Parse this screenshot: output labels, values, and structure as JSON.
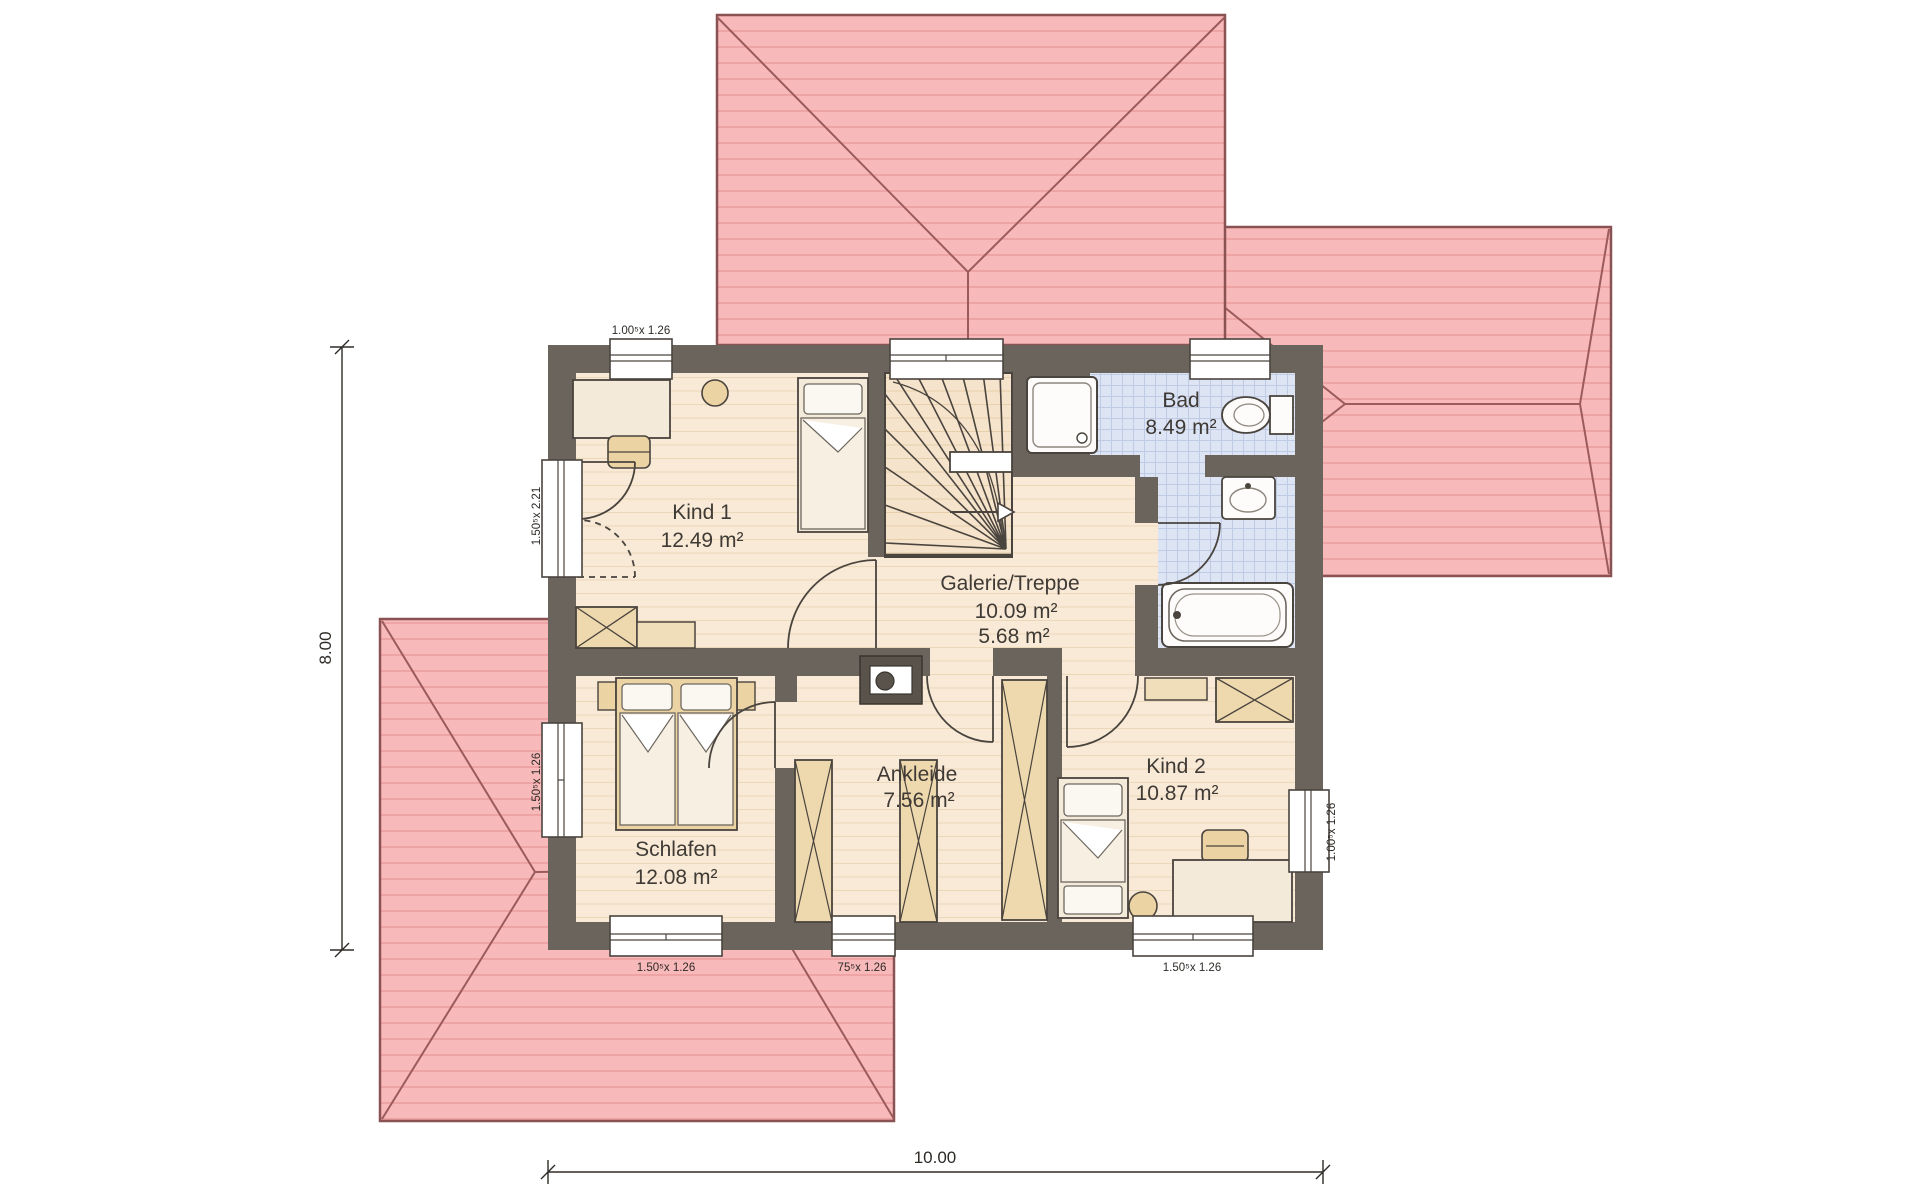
{
  "title": "Obergeschoss Grundriss",
  "rooms": {
    "kind1": {
      "name": "Kind 1",
      "area": "12.49 m²"
    },
    "galerie": {
      "name": "Galerie/Treppe",
      "area1": "10.09 m²",
      "area2": "5.68 m²"
    },
    "bad": {
      "name": "Bad",
      "area": "8.49 m²"
    },
    "schlafen": {
      "name": "Schlafen",
      "area": "12.08 m²"
    },
    "ankleide": {
      "name": "Ankleide",
      "area": "7.56 m²"
    },
    "kind2": {
      "name": "Kind 2",
      "area": "10.87 m²"
    }
  },
  "windows": {
    "top_kind1": "1.00⁵x 1.26",
    "left_door": "1.50⁵x 2.21",
    "left_schlafen": "1.50⁵x 1.26",
    "bottom_schlafen": "1.50⁵x 1.26",
    "bottom_ankleide": "75⁵x 1.26",
    "bottom_kind2": "1.50⁵x 1.26",
    "right_kind2": "1.00⁵x 1.26"
  },
  "dimensions": {
    "total_width": "10.00",
    "total_height": "8.00"
  },
  "colors": {
    "wall": "#6b645c",
    "floor": "#f8ead6",
    "tile": "#dde4f3",
    "roof": "#f7b9b9",
    "furniture_tan": "#ecd3a4"
  }
}
